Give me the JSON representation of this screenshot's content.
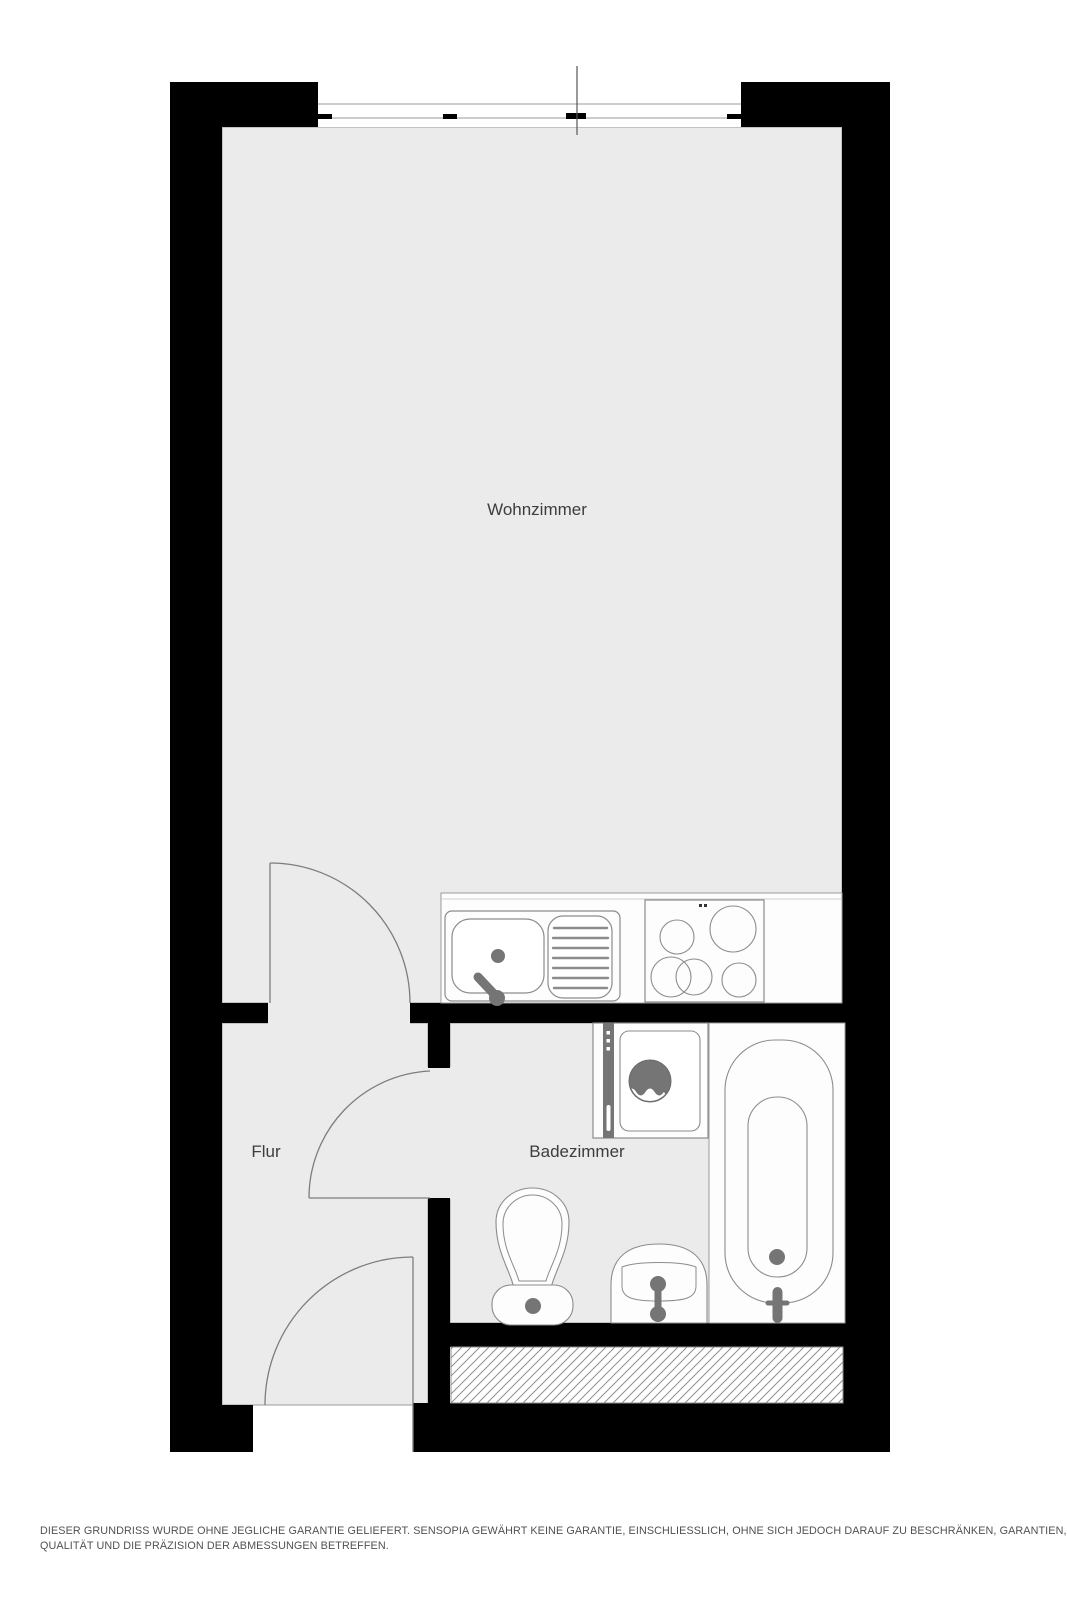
{
  "plan": {
    "title": "Grundriss / floor plan",
    "rooms": [
      {
        "id": "wohnzimmer",
        "label": "Wohnzimmer"
      },
      {
        "id": "flur",
        "label": "Flur"
      },
      {
        "id": "badezimmer",
        "label": "Badezimmer"
      }
    ],
    "fixtures": [
      "window",
      "kitchen-sink",
      "drainboard",
      "cooktop",
      "washing-machine",
      "bathtub",
      "toilet",
      "washbasin",
      "ventilation-shaft",
      "door-living",
      "door-bath",
      "door-entrance"
    ],
    "colors": {
      "wall": "#000000",
      "floor": "#ebebeb",
      "fixture_fill": "#fdfdfd",
      "outline": "#8c8c8c",
      "accent": "#757575",
      "label": "#3d3d3d"
    }
  },
  "disclaimer": {
    "line1": "DIESER GRUNDRISS WURDE OHNE JEGLICHE GARANTIE GELIEFERT. SENSOPIA GEWÄHRT KEINE GARANTIE, EINSCHLIESSLICH, OHNE SICH JEDOCH DARAUF ZU BESCHRÄNKEN, GARANTIEN, DIE DIE",
    "line2": "QUALITÄT UND DIE PRÄZISION DER ABMESSUNGEN BETREFFEN."
  }
}
